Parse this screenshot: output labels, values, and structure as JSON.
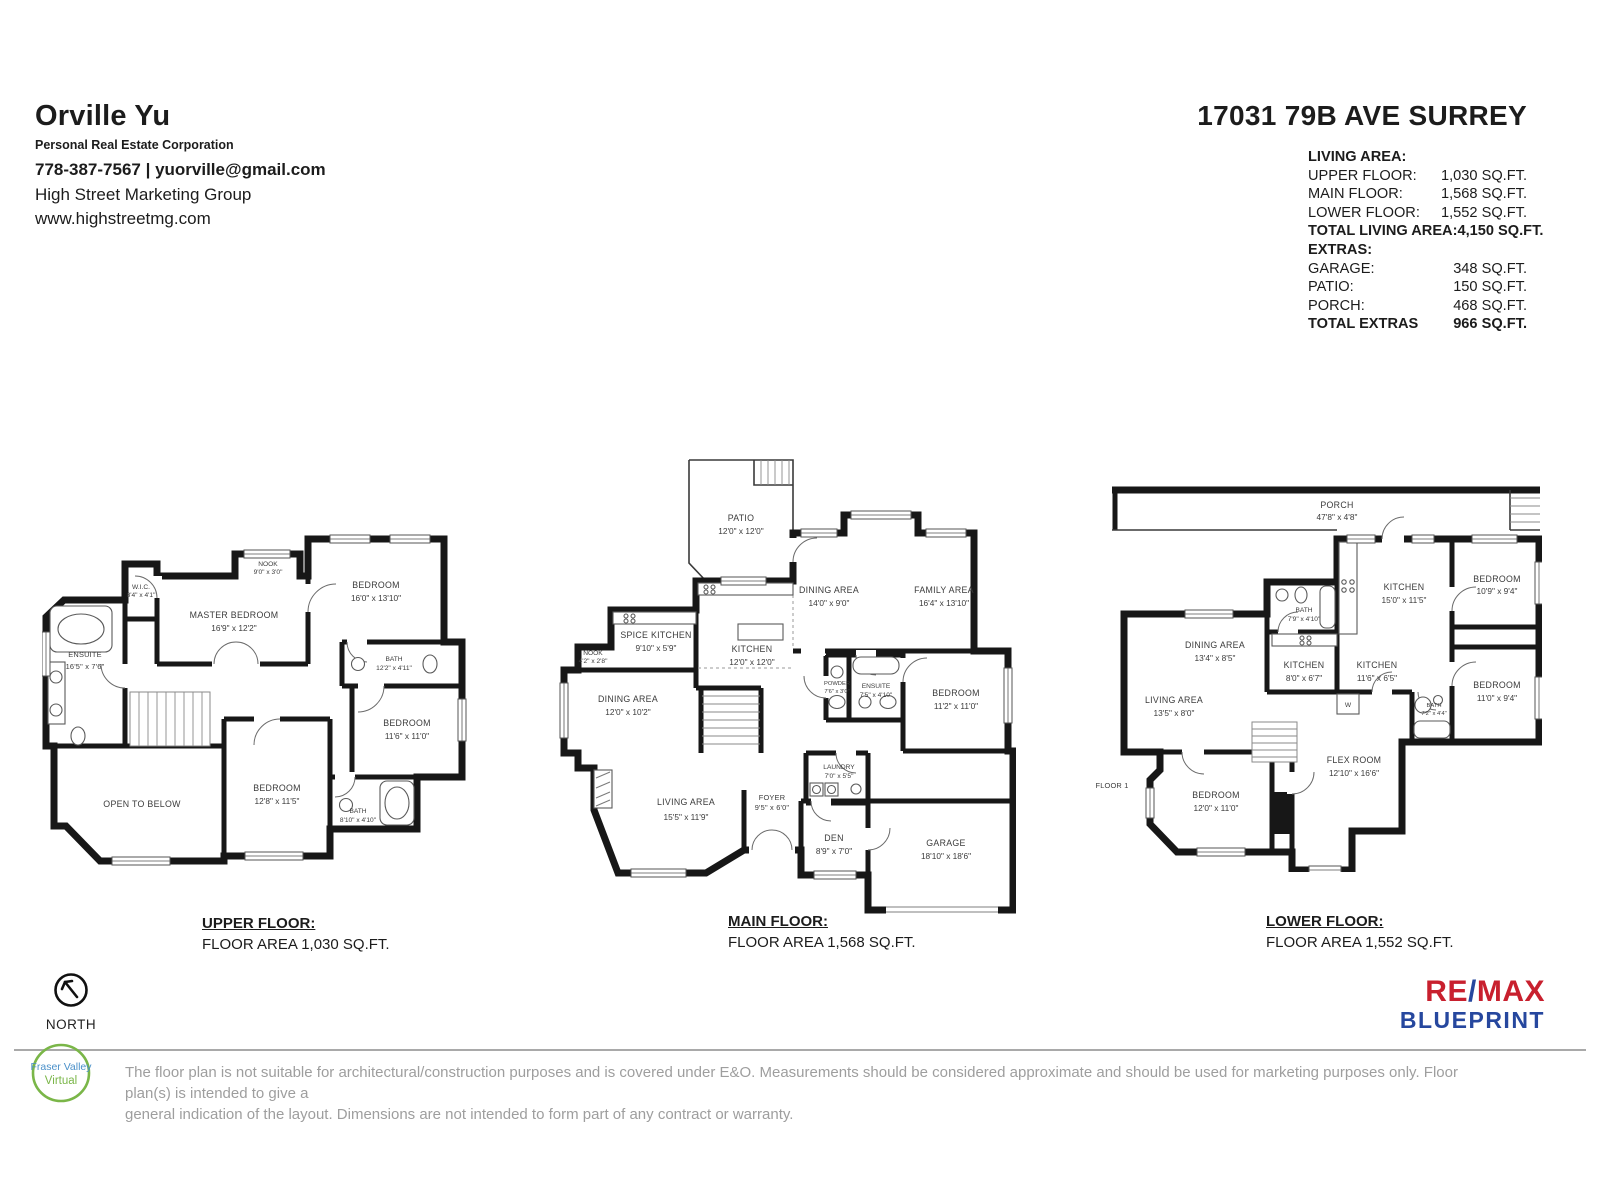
{
  "agent": {
    "name": "Orville Yu",
    "subtitle": "Personal Real Estate Corporation",
    "phone_email": "778-387-7567 | yuorville@gmail.com",
    "company": "High Street Marketing Group",
    "website": "www.highstreetmg.com"
  },
  "property": {
    "address": "17031 79B AVE SURREY",
    "living_heading": "LIVING AREA:",
    "living_rows": [
      {
        "label": "UPPER FLOOR:",
        "value": "1,030 SQ.FT."
      },
      {
        "label": "MAIN FLOOR:",
        "value": "1,568 SQ.FT."
      },
      {
        "label": "LOWER FLOOR:",
        "value": "1,552 SQ.FT."
      },
      {
        "label": "TOTAL LIVING AREA:",
        "value": "4,150 SQ.FT."
      }
    ],
    "extras_heading": "EXTRAS:",
    "extras_rows": [
      {
        "label": "GARAGE:",
        "value": "348 SQ.FT."
      },
      {
        "label": "PATIO:",
        "value": "150 SQ.FT."
      },
      {
        "label": "PORCH:",
        "value": "468 SQ.FT."
      },
      {
        "label": "TOTAL EXTRAS",
        "value": "966 SQ.FT."
      }
    ]
  },
  "floors": {
    "upper": {
      "title": "UPPER FLOOR:",
      "area": "FLOOR AREA 1,030 SQ.FT.",
      "rooms": {
        "nook": {
          "name": "NOOK",
          "dims": "9'0\" x 3'0\""
        },
        "wic": {
          "name": "W.I.C.",
          "dims": "8'4\" x 4'1\""
        },
        "master": {
          "name": "MASTER BEDROOM",
          "dims": "16'9\" x 12'2\""
        },
        "bedroom_tr": {
          "name": "BEDROOM",
          "dims": "16'0\" x 13'10\""
        },
        "ensuite": {
          "name": "ENSUITE",
          "dims": "16'5\" x 7'6\""
        },
        "bath1": {
          "name": "BATH",
          "dims": "12'2\" x 4'11\""
        },
        "bedroom_r": {
          "name": "BEDROOM",
          "dims": "11'6\" x 11'0\""
        },
        "open_below": {
          "name": "OPEN TO BELOW"
        },
        "bedroom_b": {
          "name": "BEDROOM",
          "dims": "12'8\" x 11'5\""
        },
        "bath2": {
          "name": "BATH",
          "dims": "8'10\" x 4'10\""
        }
      }
    },
    "main": {
      "title": "MAIN FLOOR:",
      "area": "FLOOR AREA 1,568 SQ.FT.",
      "rooms": {
        "patio": {
          "name": "PATIO",
          "dims": "12'0\" x 12'0\""
        },
        "dining1": {
          "name": "DINING AREA",
          "dims": "14'0\" x 9'0\""
        },
        "family": {
          "name": "FAMILY AREA",
          "dims": "16'4\" x 13'10\""
        },
        "spice": {
          "name": "SPICE KITCHEN",
          "dims": "9'10\" x 5'9\""
        },
        "nook": {
          "name": "NOOK",
          "dims": "4'2\" x 2'8\""
        },
        "kitchen": {
          "name": "KITCHEN",
          "dims": "12'0\" x 12'0\""
        },
        "dining2": {
          "name": "DINING AREA",
          "dims": "12'0\" x 10'2\""
        },
        "powder": {
          "name": "POWDER",
          "dims": "7'6\" x 3'0\""
        },
        "ensuite": {
          "name": "ENSUITE",
          "dims": "7'5\" x 4'10\""
        },
        "bedroom": {
          "name": "BEDROOM",
          "dims": "11'2\" x 11'0\""
        },
        "laundry": {
          "name": "LAUNDRY",
          "dims": "7'0\" x 5'5\""
        },
        "living": {
          "name": "LIVING AREA",
          "dims": "15'5\" x 11'9\""
        },
        "foyer": {
          "name": "FOYER",
          "dims": "9'5\" x 6'0\""
        },
        "den": {
          "name": "DEN",
          "dims": "8'9\" x 7'0\""
        },
        "garage": {
          "name": "GARAGE",
          "dims": "18'10\" x 18'6\""
        }
      }
    },
    "lower": {
      "title": "LOWER FLOOR:",
      "area": "FLOOR AREA 1,552 SQ.FT.",
      "floor_label": "FLOOR 1",
      "washer_label": "W",
      "rooms": {
        "porch": {
          "name": "PORCH",
          "dims": "47'8\" x 4'8\""
        },
        "kitchen1": {
          "name": "KITCHEN",
          "dims": "15'0\" x 11'5\""
        },
        "bedroom1": {
          "name": "BEDROOM",
          "dims": "10'9\" x 9'4\""
        },
        "bath1": {
          "name": "BATH",
          "dims": "7'9\" x 4'10\""
        },
        "dining": {
          "name": "DINING AREA",
          "dims": "13'4\" x 8'5\""
        },
        "kitchen2": {
          "name": "KITCHEN",
          "dims": "8'0\" x 6'7\""
        },
        "kitchen3": {
          "name": "KITCHEN",
          "dims": "11'6\" x 6'5\""
        },
        "bedroom2": {
          "name": "BEDROOM",
          "dims": "11'0\" x 9'4\""
        },
        "bath2": {
          "name": "BATH",
          "dims": "7'2\" x 4'4\""
        },
        "living": {
          "name": "LIVING AREA",
          "dims": "13'5\" x 8'0\""
        },
        "flex": {
          "name": "FLEX ROOM",
          "dims": "12'10\" x 16'6\""
        },
        "bedroom3": {
          "name": "BEDROOM",
          "dims": "12'0\" x 11'0\""
        }
      }
    }
  },
  "footer": {
    "north_label": "NORTH",
    "disclaimer_line1": "The floor plan is not suitable for architectural/construction purposes and is covered under E&O. Measurements should be considered  approximate and should be used for marketing purposes only. Floor plan(s) is intended to give a",
    "disclaimer_line2": "general indication of the layout. Dimensions are not intended to form part of any contract or warranty.",
    "fv_line1": "Fraser Valley",
    "fv_line2": "Virtual",
    "remax_re": "RE",
    "remax_slash": "/",
    "remax_max": "MAX",
    "remax_blueprint": "BLUEPRINT"
  },
  "colors": {
    "wall": "#171717",
    "remax_red": "#c8202e",
    "remax_blue": "#26479e",
    "fv_green": "#7ab648",
    "fv_blue": "#4a90c9",
    "disclaimer_gray": "#9e9e9e"
  }
}
